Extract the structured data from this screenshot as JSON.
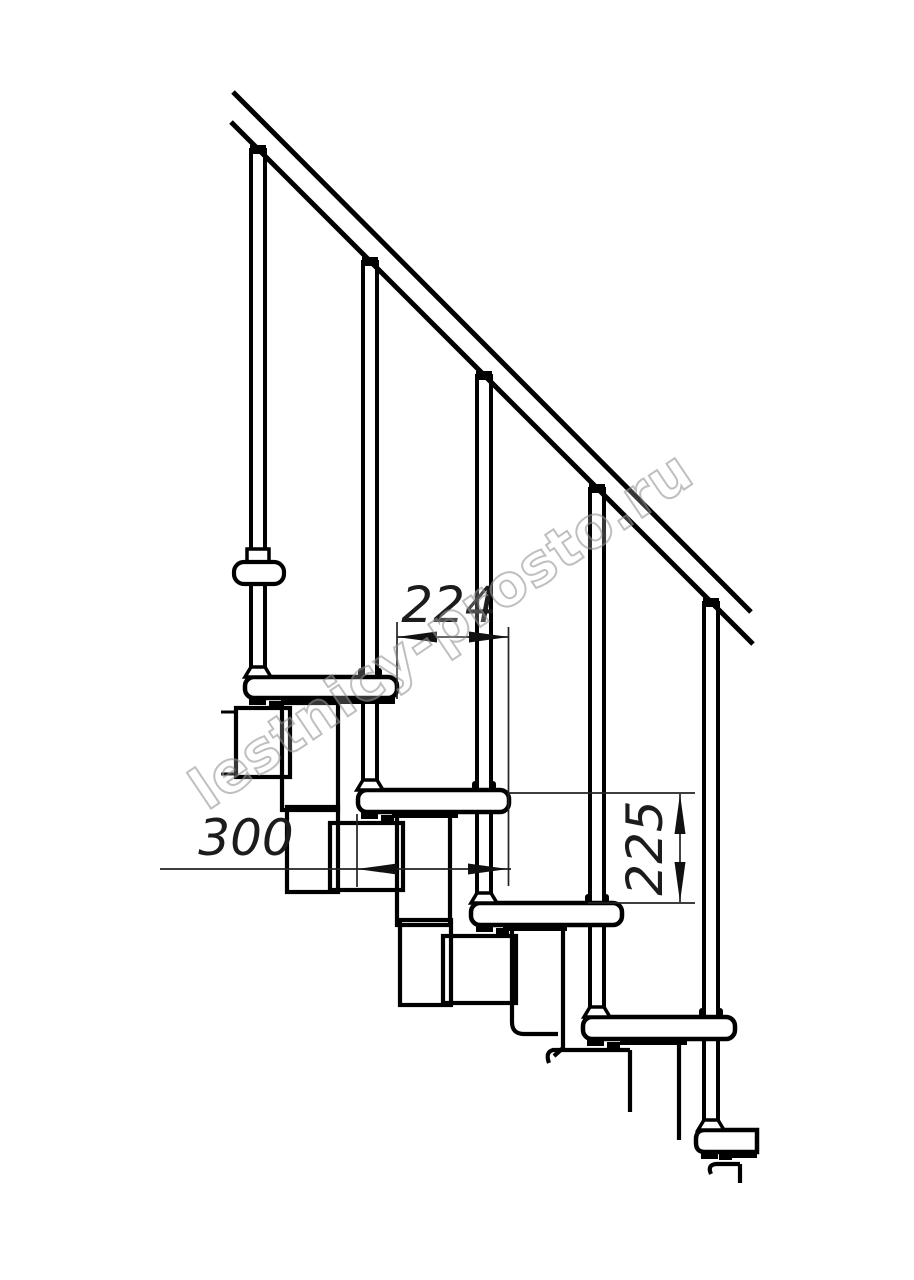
{
  "drawing": {
    "kind": "modular staircase side-view technical drawing",
    "background": "#ffffff",
    "line_color": "#000000",
    "dim_line_color": "#222222"
  },
  "dimensions": {
    "step_run": "224",
    "tread_depth": "300",
    "step_rise": "225"
  },
  "watermark": {
    "text": "lestnicy-prosto.ru",
    "color": "#999999"
  }
}
